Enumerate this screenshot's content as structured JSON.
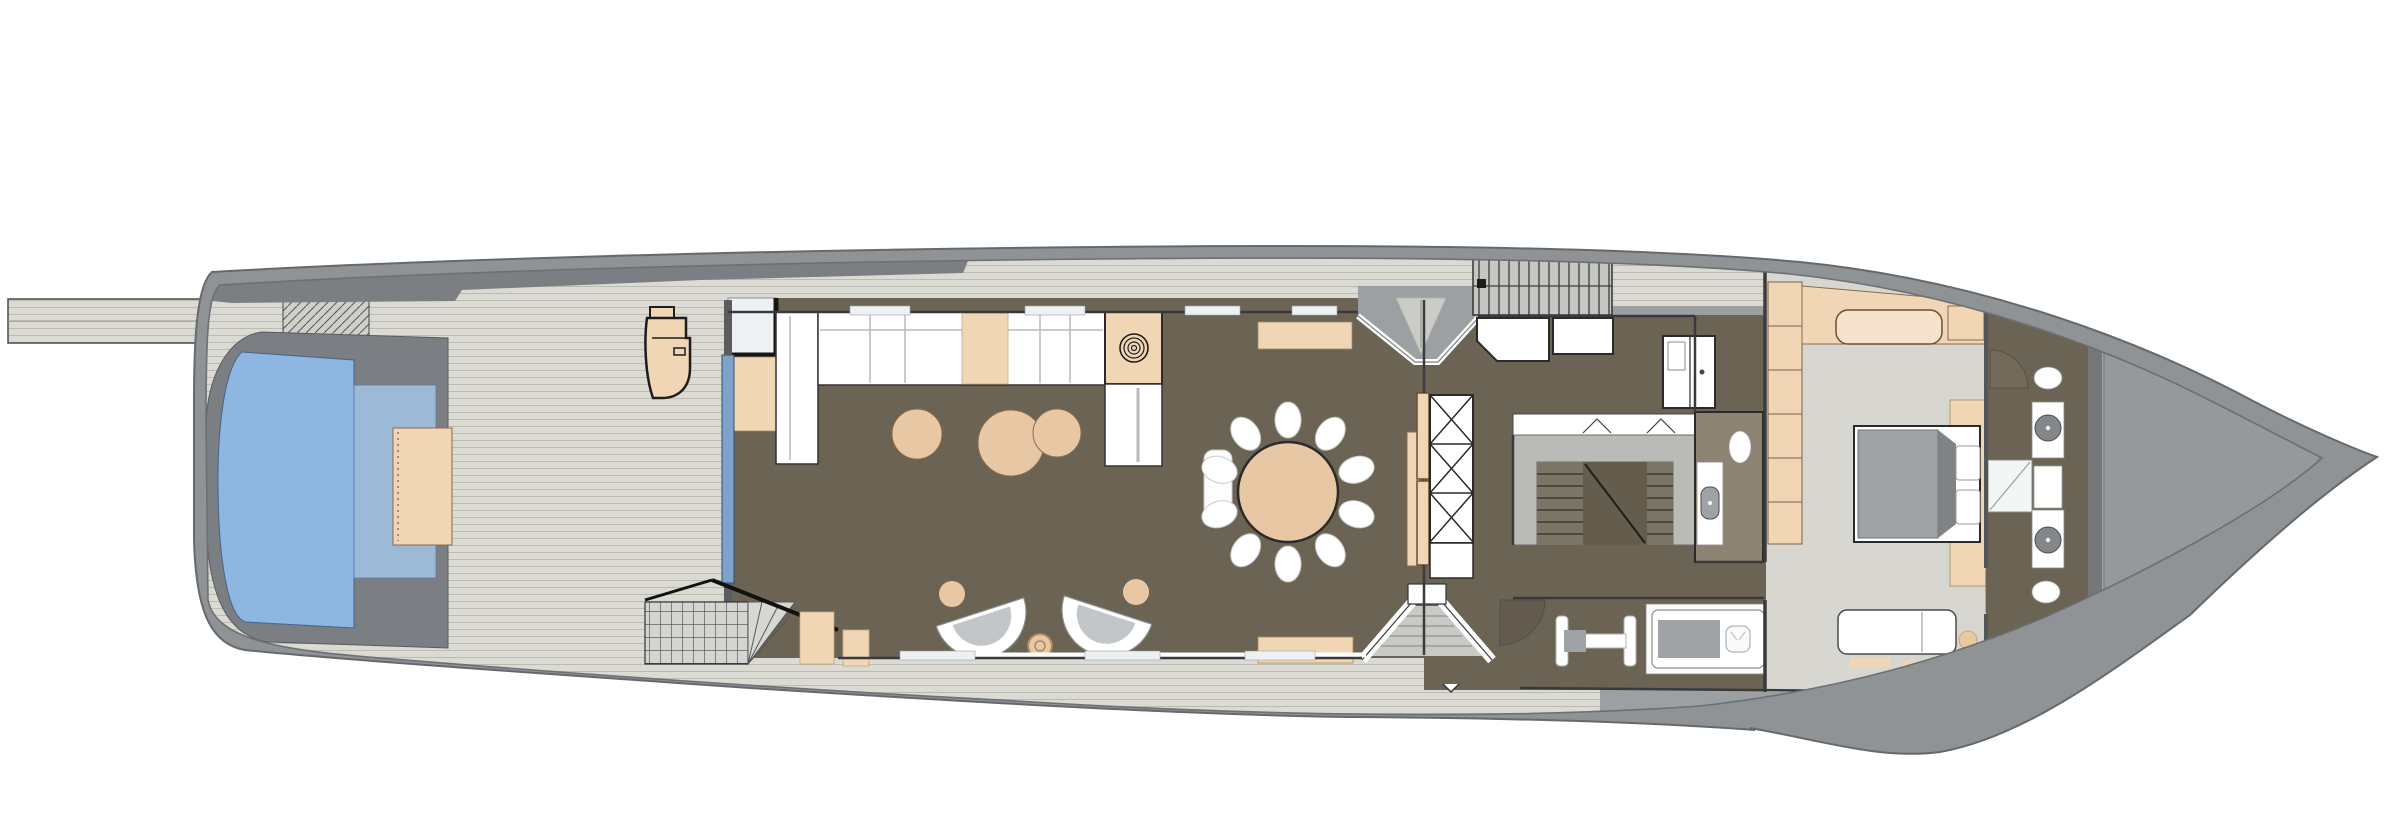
{
  "meta": {
    "drawing": "yacht-deck-plan",
    "deck": "main-deck",
    "orientation": "bow-right",
    "background": "#ffffff"
  },
  "colors": {
    "hull": "#909396",
    "hull_dark": "#7b7e82",
    "deck_gray": "#9da0a3",
    "teak_base": "#dbdad3",
    "teak_stripe": "#bcbbb1",
    "grid_base": "#d4d5d1",
    "floor_brown": "#6b6353",
    "floor_tan": "#8d8372",
    "carpet": "#d8d6d0",
    "sand": "#f1d6b6",
    "sand_deep": "#e8c7a4",
    "pool_blue": "#8db7e0",
    "pool_shelf": "#9db9d8",
    "glass_blue": "#7fa2c8",
    "furn_gray": "#a0a3a6",
    "steel": "#babbb7",
    "foredeck": "#a2a5a8",
    "foredeck_panel": "#96999b",
    "line_dark": "#2e2e2e",
    "bulwark_line": "#6d7073"
  },
  "dining": {
    "seats": 10,
    "cx": 1288,
    "cy": 492,
    "radius": 72,
    "chair_rx": 13,
    "chair_ry": 18,
    "table_radius": 50
  },
  "semantics": {
    "rooms": [
      {
        "id": "passerelle",
        "label": "passerelle gangway"
      },
      {
        "id": "aft-deck",
        "label": "aft deck with pool"
      },
      {
        "id": "pool",
        "label": "swimming pool"
      },
      {
        "id": "sun-pad",
        "label": "pool-side sun pad"
      },
      {
        "id": "main-salon",
        "label": "main salon"
      },
      {
        "id": "dining-room",
        "label": "dining room, 10 seats"
      },
      {
        "id": "vestibule",
        "label": "side entrance vestibule"
      },
      {
        "id": "boarding-stairs",
        "label": "side boarding stairs"
      },
      {
        "id": "foyer-pantry",
        "label": "foyer and pantry"
      },
      {
        "id": "main-staircase",
        "label": "main staircase"
      },
      {
        "id": "day-head",
        "label": "day head WC"
      },
      {
        "id": "gym",
        "label": "gym corner"
      },
      {
        "id": "massage-room",
        "label": "massage room"
      },
      {
        "id": "master-cabin",
        "label": "owner master cabin"
      },
      {
        "id": "master-bathroom",
        "label": "master bathroom his and hers"
      },
      {
        "id": "foredeck",
        "label": "foredeck"
      }
    ]
  }
}
